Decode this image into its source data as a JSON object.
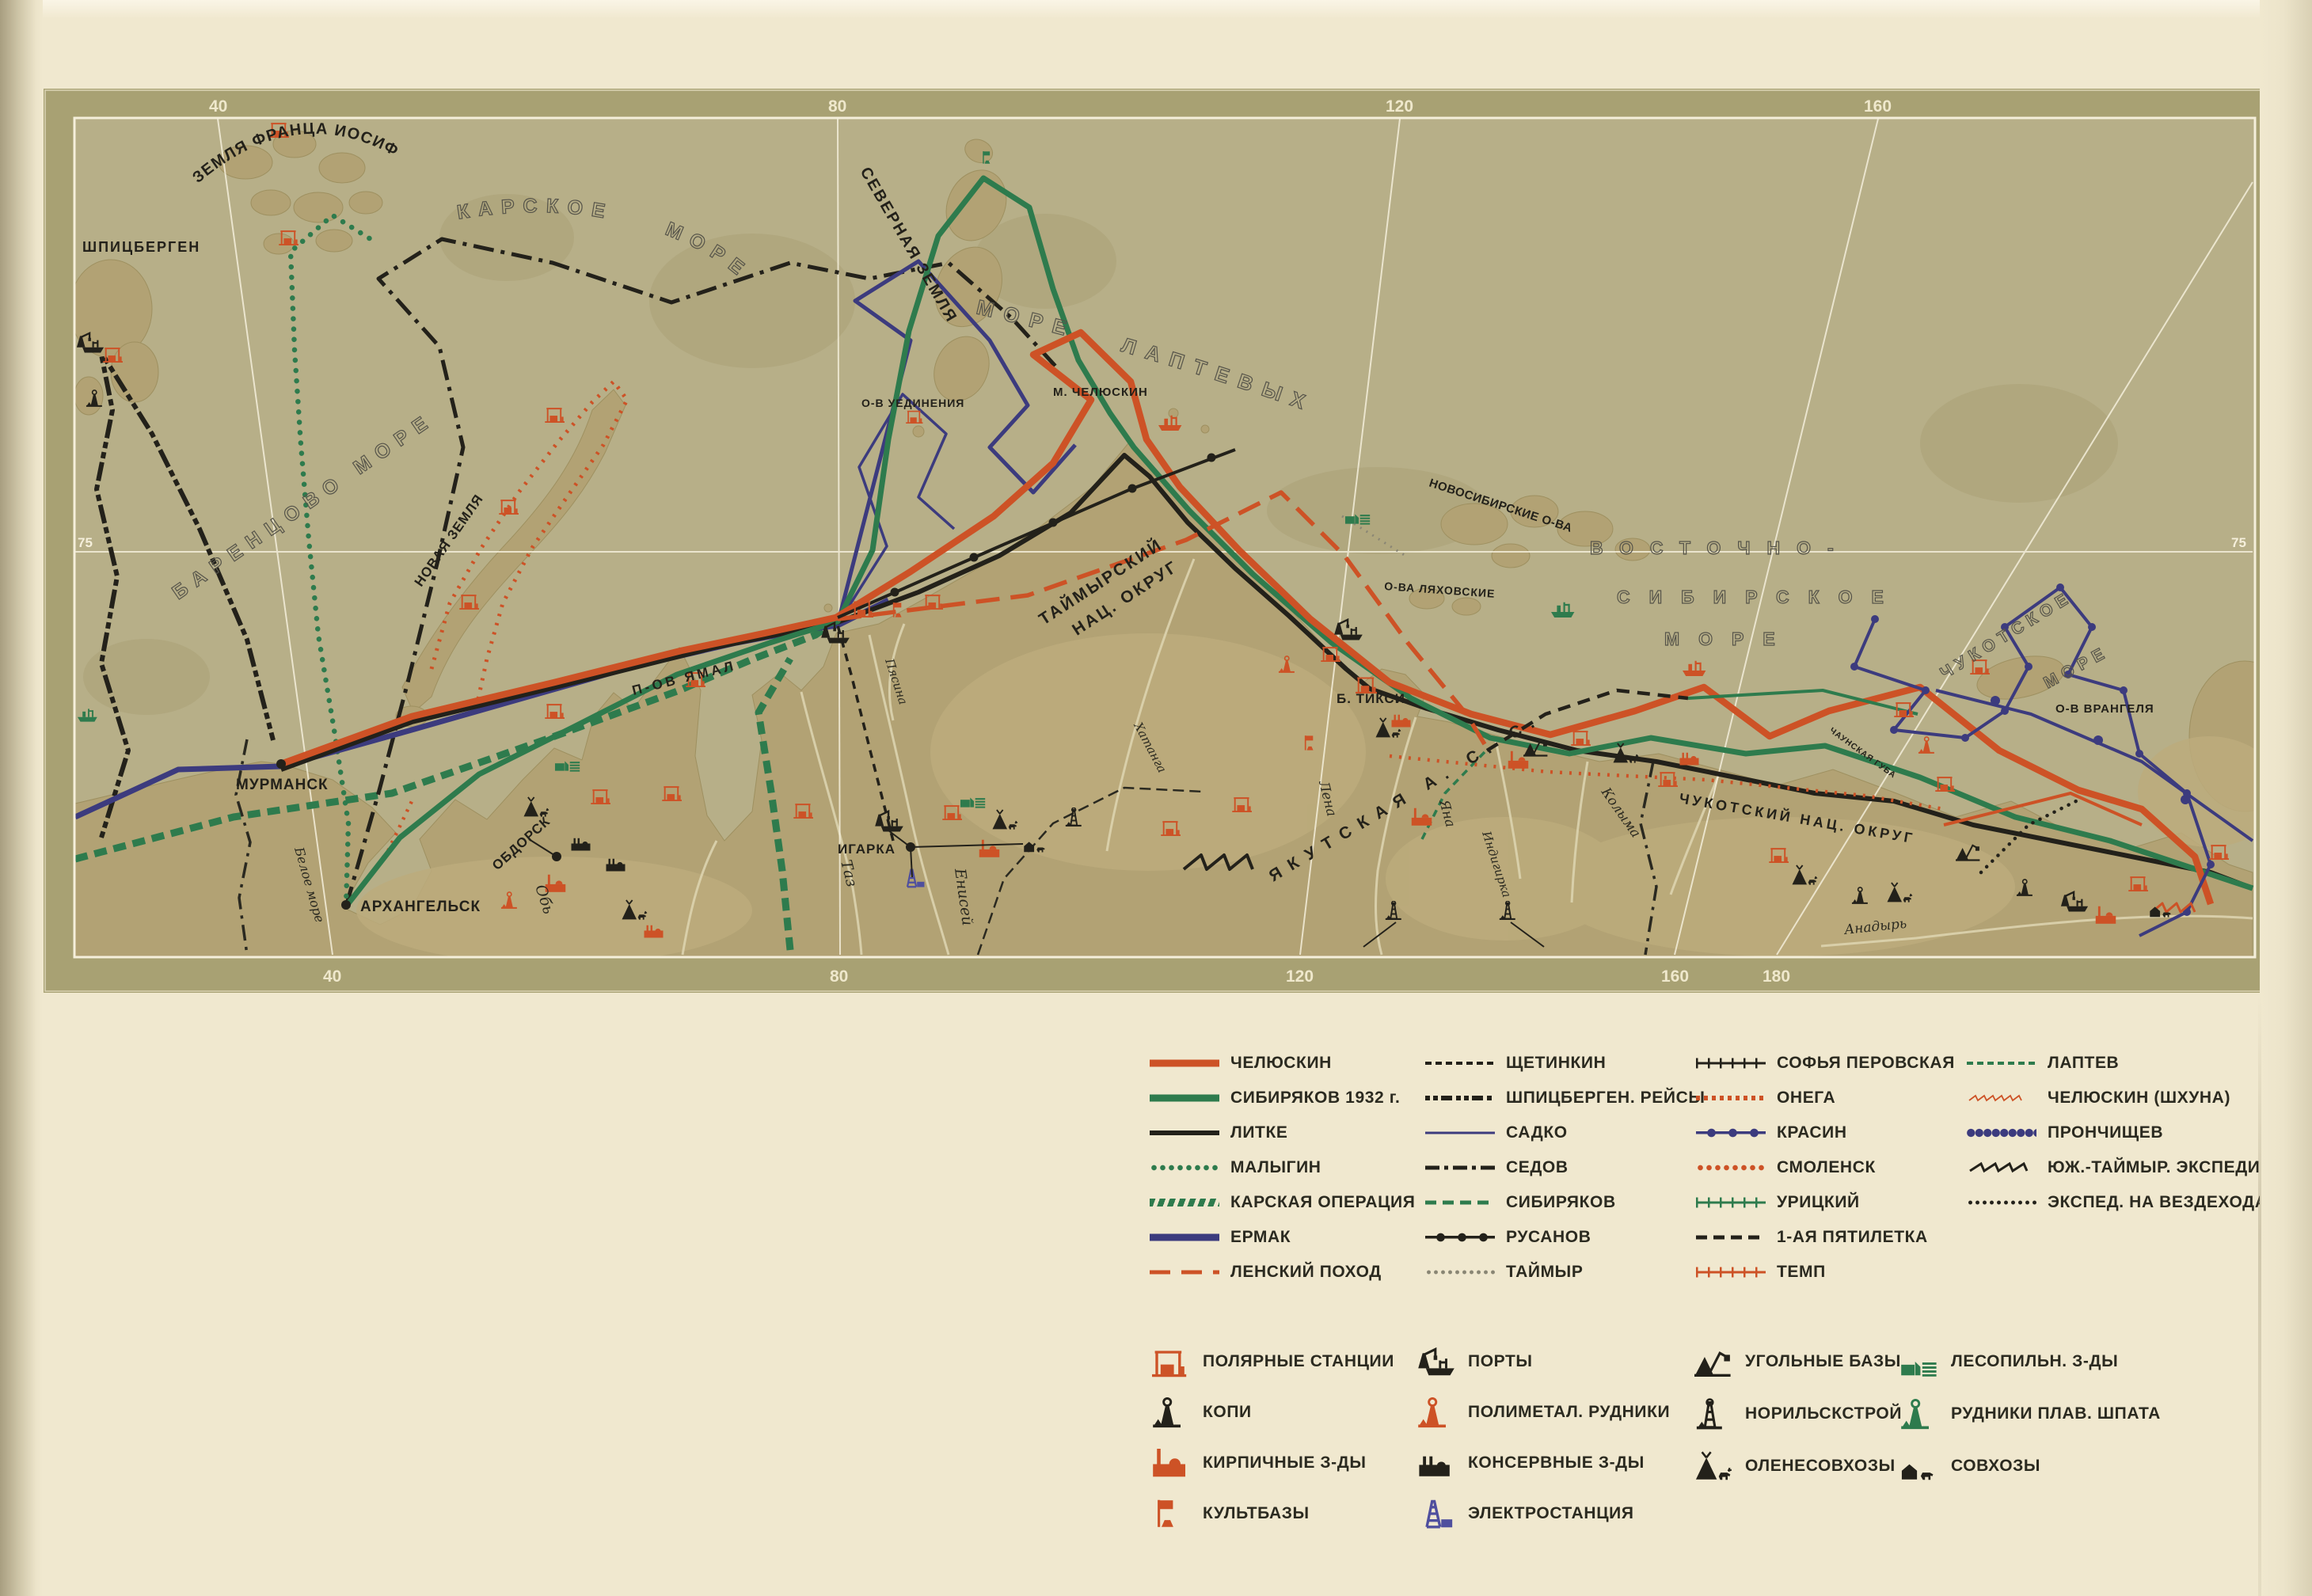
{
  "map": {
    "grid": {
      "top": [
        "40",
        "80",
        "120",
        "160"
      ],
      "bottom": [
        "40",
        "80",
        "120",
        "160",
        "180"
      ],
      "parallel_left": "75",
      "parallel_right": "75"
    },
    "labels": {
      "spitsbergen": "ШПИЦБЕРГЕН",
      "franz_josef": "ЗЕМЛЯ ФРАНЦА ИОСИФА",
      "barents_sea": "БАРЕНЦОВО МОРЕ",
      "kara_sea": "КАРСКОЕ МОРЕ",
      "severnaya_zemlya": "СЕВЕРНАЯ ЗЕМЛЯ",
      "laptev_sea": "МОРЕ ЛАПТЕВЫХ",
      "east_sib_1": "ВОСТОЧНО-",
      "east_sib_2": "СИБИРСКОЕ",
      "east_sib_3": "МОРЕ",
      "chukchi_1": "ЧУКОТСКОЕ",
      "chukchi_2": "МОРЕ",
      "novaya_zemlya": "НОВАЯ ЗЕМЛЯ",
      "yamal": "П-ОВ ЯМАЛ",
      "novosibirsk_isl": "НОВОСИБИРСКИЕ О-ВА",
      "lyakhovskie": "О-ВА ЛЯХОВСКИЕ",
      "uedineniya": "О-В УЕДИНЕНИЯ",
      "cape_chelyuskin": "М. ЧЕЛЮСКИН",
      "wrangel": "О-В ВРАНГЕЛЯ",
      "taimyr_1": "ТАЙМЫРСКИЙ",
      "taimyr_2": "НАЦ. ОКРУГ",
      "yakutia": "ЯКУТСКАЯ  А. С. С. Р.",
      "chukotka_okrug": "ЧУКОТСКИЙ НАЦ. ОКРУГ",
      "chaun_bay": "ЧАУНСКАЯ ГУБА",
      "white_sea": "Белое море"
    },
    "cities": {
      "murmansk": "МУРМАНСК",
      "arkhangelsk": "АРХАНГЕЛЬСК",
      "obdorsk": "ОБДОРСК",
      "igarka": "ИГАРКА",
      "tiksi": "Б. ТИКСИ"
    },
    "rivers": {
      "ob": "Обь",
      "taz": "Таз",
      "yenisei": "Енисей",
      "pyasina": "Пясина",
      "khatanga": "Хатанга",
      "lena": "Лена",
      "yana": "Яна",
      "indigirka": "Индигирка",
      "kolyma": "Колыма",
      "anadyr": "Анадырь"
    }
  },
  "legend": {
    "routes": [
      {
        "label": "ЧЕЛЮСКИН"
      },
      {
        "label": "СИБИРЯКОВ 1932 г."
      },
      {
        "label": "ЛИТКЕ"
      },
      {
        "label": "МАЛЫГИН"
      },
      {
        "label": "КАРСКАЯ ОПЕРАЦИЯ"
      },
      {
        "label": "ЕРМАК"
      },
      {
        "label": "ЛЕНСКИЙ ПОХОД"
      },
      {
        "label": "ЩЕТИНКИН"
      },
      {
        "label": "ШПИЦБЕРГЕН. РЕЙСЫ"
      },
      {
        "label": "САДКО"
      },
      {
        "label": "СЕДОВ"
      },
      {
        "label": "СИБИРЯКОВ"
      },
      {
        "label": "РУСАНОВ"
      },
      {
        "label": "ТАЙМЫР"
      },
      {
        "label": "СОФЬЯ ПЕРОВСКАЯ"
      },
      {
        "label": "ОНЕГА"
      },
      {
        "label": "КРАСИН"
      },
      {
        "label": "СМОЛЕНСК"
      },
      {
        "label": "УРИЦКИЙ"
      },
      {
        "label": "1-АЯ ПЯТИЛЕТКА"
      },
      {
        "label": "ТЕМП"
      },
      {
        "label": "ЛАПТЕВ"
      },
      {
        "label": "ЧЕЛЮСКИН (ШХУНА)"
      },
      {
        "label": "ПРОНЧИЩЕВ"
      },
      {
        "label": "ЮЖ.-ТАЙМЫР. ЭКСПЕДИЦ."
      },
      {
        "label": "ЭКСПЕД. НА ВЕЗДЕХОДАХ"
      }
    ],
    "objects": [
      {
        "label": "ПОЛЯРНЫЕ СТАНЦИИ"
      },
      {
        "label": "КОПИ"
      },
      {
        "label": "КИРПИЧНЫЕ З-ДЫ"
      },
      {
        "label": "КУЛЬТБАЗЫ"
      },
      {
        "label": "ПОРТЫ"
      },
      {
        "label": "ПОЛИМЕТАЛ. РУДНИКИ"
      },
      {
        "label": "КОНСЕРВНЫЕ З-ДЫ"
      },
      {
        "label": "ЭЛЕКТРОСТАНЦИЯ"
      },
      {
        "label": "УГОЛЬНЫЕ БАЗЫ"
      },
      {
        "label": "НОРИЛЬСКСТРОЙ"
      },
      {
        "label": "ОЛЕНЕСОВХОЗЫ"
      },
      {
        "label": "ЛЕСОПИЛЬН. З-ДЫ"
      },
      {
        "label": "РУДНИКИ ПЛАВ. ШПАТА"
      },
      {
        "label": "СОВХОЗЫ"
      }
    ]
  }
}
